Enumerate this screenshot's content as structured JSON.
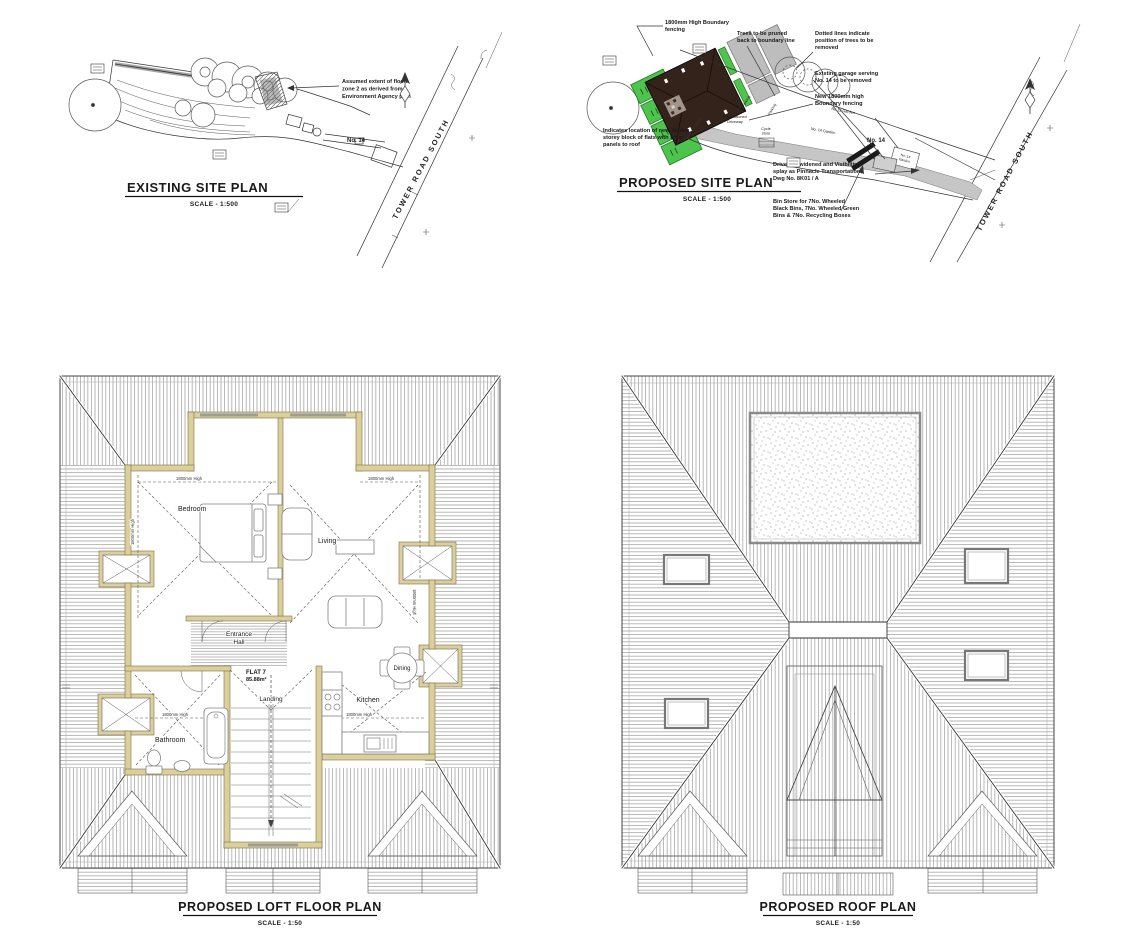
{
  "page": {
    "background": "#ffffff"
  },
  "panels": {
    "existing_site_plan": {
      "title": "EXISTING SITE PLAN",
      "scale": "SCALE - 1:500",
      "road": "TOWER ROAD SOUTH",
      "no14": "No. 14",
      "flood_note": [
        "Assumed extent of flood",
        "zone 2 as derived from",
        "Environment Agency plan"
      ]
    },
    "proposed_site_plan": {
      "title": "PROPOSED SITE PLAN",
      "scale": "SCALE - 1:500",
      "road": "TOWER ROAD SOUTH",
      "no14": "No. 14",
      "labels": {
        "parking": "Parking",
        "repositioned_driveway": [
          "Re-positioned",
          "Driveway"
        ],
        "cycle_store": [
          "Cycle",
          "store"
        ],
        "no12_garden": "No 12 Garden",
        "no14_garden": "No. 14 Garden",
        "no14_garden_box": [
          "No. 14",
          "Garden"
        ]
      },
      "notes": {
        "boundary_fencing": [
          "1800mm High Boundary",
          "fencing"
        ],
        "trees_pruned": [
          "Trees to be pruned",
          "back to boundary line"
        ],
        "trees_removed": [
          "Dotted lines indicate",
          "position of trees to be",
          "removed"
        ],
        "garage_removed": [
          "Existing garage serving",
          "No. 14 to be removed"
        ],
        "new_fencing": [
          "New 1800mm high",
          "Boundary fencing"
        ],
        "new_block": [
          "Indicates location of new double",
          "storey block of flats with solar",
          "panels to roof"
        ],
        "driveway": [
          "Driveway widened and Visibility",
          "splay as Pinnacle Transportation",
          "Dwg No. 8K01 / A"
        ],
        "bin_store": [
          "Bin Store for 7No. Wheeled",
          "Black Bins, 7No. Wheeled Green",
          "Bins & 7No. Recycling Boxes"
        ]
      },
      "colors": {
        "new_block": "#33231a",
        "fencing_green": "#4ec44e",
        "driveway": "#c6c6c6"
      }
    },
    "loft_floor_plan": {
      "title": "PROPOSED LOFT FLOOR PLAN",
      "scale": "SCALE - 1:50",
      "flat_name": "FLAT 7",
      "flat_area": "85.88m²",
      "rooms": {
        "bedroom": "Bedroom",
        "living": "Living",
        "entrance": [
          "Entrance",
          "Hall"
        ],
        "landing": "Landing",
        "bathroom": "Bathroom",
        "kitchen": "Kitchen",
        "dining": "Dining"
      },
      "height_note": "1800mm High",
      "colors": {
        "wall": "#dbd09c"
      }
    },
    "roof_plan": {
      "title": "PROPOSED ROOF PLAN",
      "scale": "SCALE - 1:50"
    }
  }
}
